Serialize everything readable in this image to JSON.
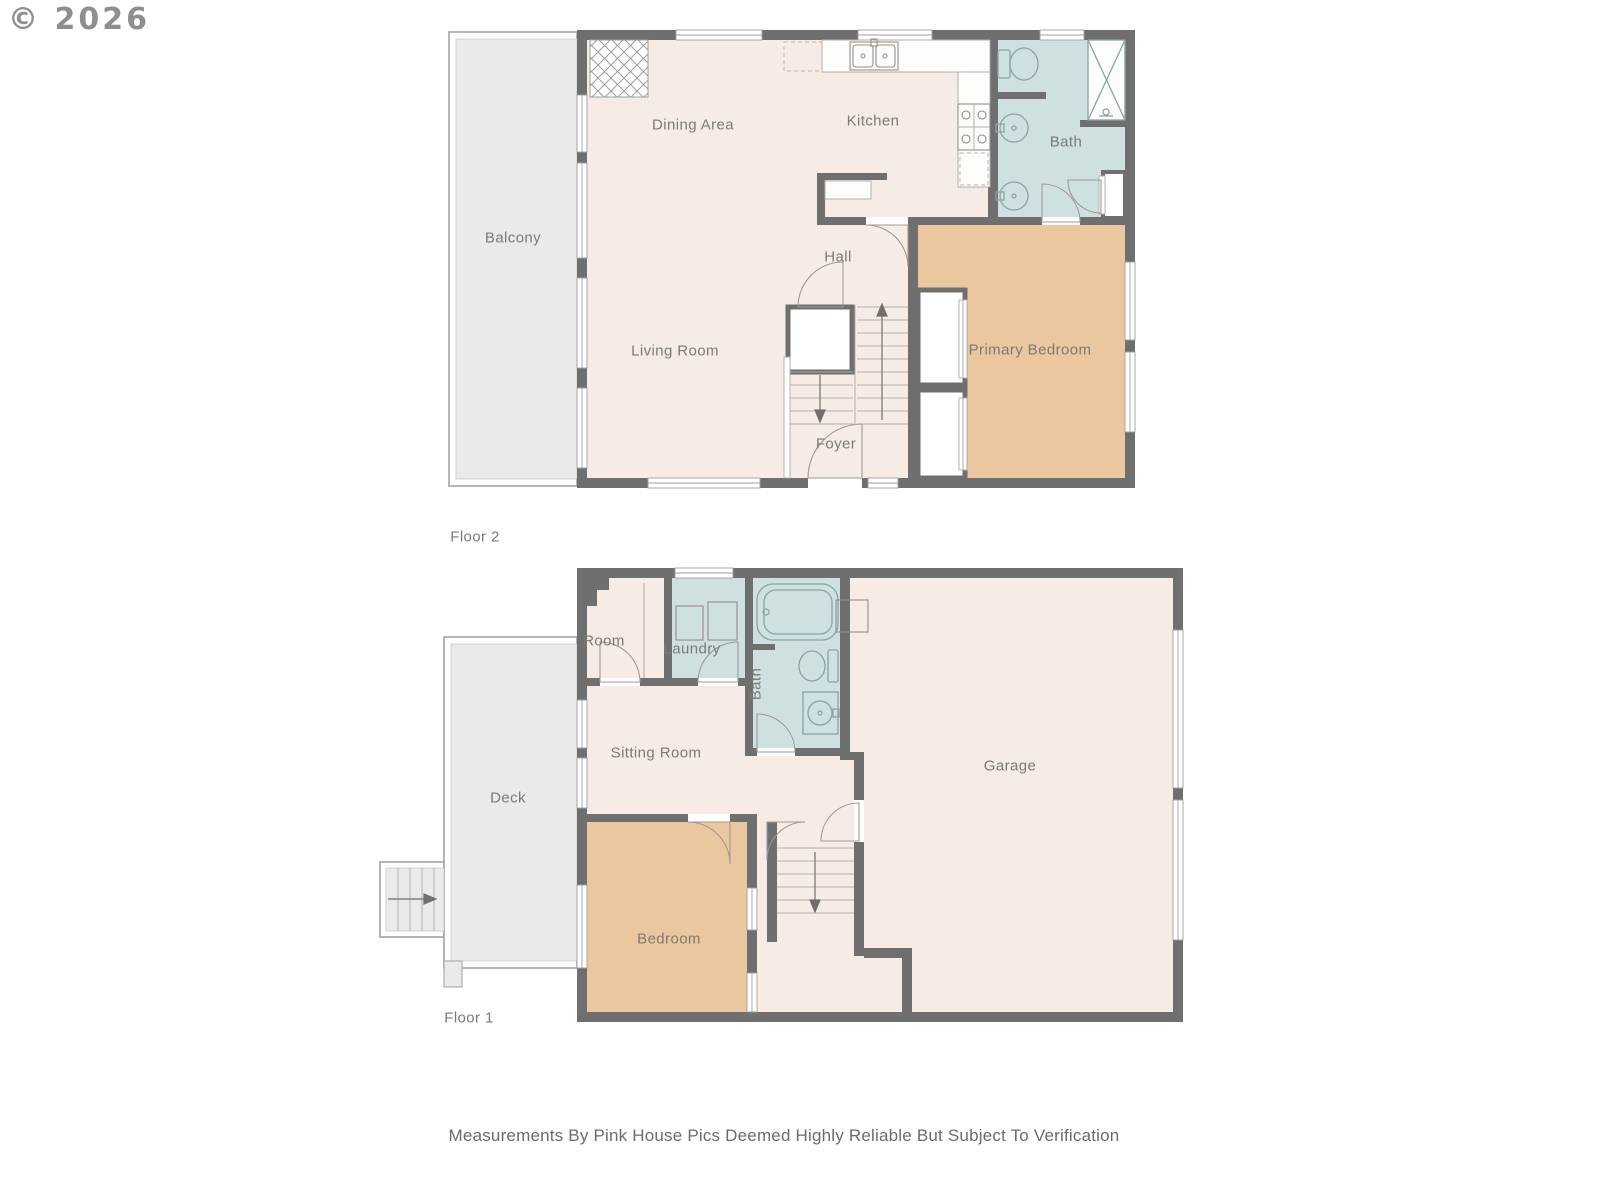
{
  "copyright": "© 2026",
  "disclaimer": "Measurements By Pink House Pics Deemed Highly Reliable But Subject To Verification",
  "floor2": {
    "label": "Floor 2",
    "rooms": {
      "balcony": "Balcony",
      "dining_area": "Dining Area",
      "kitchen": "Kitchen",
      "bath": "Bath",
      "hall": "Hall",
      "living_room": "Living Room",
      "primary_bedroom": "Primary Bedroom",
      "foyer": "Foyer"
    }
  },
  "floor1": {
    "label": "Floor 1",
    "rooms": {
      "room": "Room",
      "laundry": "Laundry",
      "bath": "Bath",
      "sitting_room": "Sitting Room",
      "deck": "Deck",
      "garage": "Garage",
      "bedroom": "Bedroom"
    }
  },
  "colors": {
    "wall": "#6f6f6f",
    "floor": "#f7ece5",
    "bedroom": "#ebc79f",
    "bath": "#cfe0e1",
    "deck": "#e9ebeb",
    "text": "#7b7a74"
  }
}
